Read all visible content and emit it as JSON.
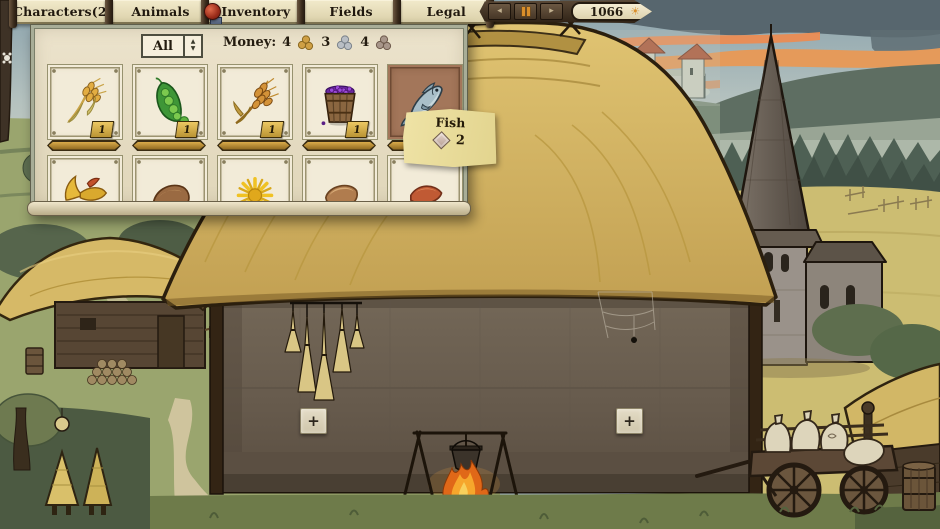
{
  "menu": {
    "tabs": [
      "Characters(2)",
      "Animals",
      "Inventory",
      "Fields",
      "Legal"
    ]
  },
  "time_controls": {
    "year": "1066",
    "slower_icon": "◂",
    "faster_icon": "▸",
    "sun_icon": "☀"
  },
  "inventory_panel": {
    "filter_value": "All",
    "spinner_up": "▲",
    "spinner_down": "▼",
    "money_label": "Money:",
    "money": [
      {
        "amount": "4",
        "coin": "gold"
      },
      {
        "amount": "3",
        "coin": "silver"
      },
      {
        "amount": "4",
        "coin": "copper"
      }
    ],
    "slots_row1": [
      {
        "item": "wheat",
        "count": "1"
      },
      {
        "item": "peas",
        "count": "1"
      },
      {
        "item": "barley",
        "count": "1"
      },
      {
        "item": "berry-bucket",
        "count": "1"
      },
      {
        "item": "fish",
        "count": "",
        "state": "hovered"
      }
    ],
    "slots_row2": [
      {
        "item": "fish-tail"
      },
      {
        "item": "hide"
      },
      {
        "item": "dandelion"
      },
      {
        "item": "bread"
      },
      {
        "item": "meat"
      }
    ]
  },
  "tooltip": {
    "item_name": "Fish",
    "price": "2"
  },
  "house": {
    "add_slot_left": "+",
    "add_slot_right": "+"
  },
  "colors": {
    "parchment": "#e8dfc6",
    "gold_badge": "#c9a23e",
    "hover_slot": "#a3765a",
    "accent_orange": "#d98e2a",
    "seal_red": "#a83222"
  }
}
